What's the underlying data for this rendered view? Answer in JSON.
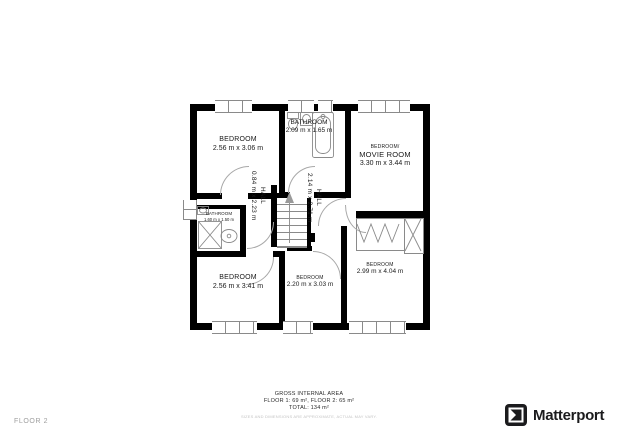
{
  "floor_label": "FLOOR 2",
  "rooms": {
    "bedroom_tl": {
      "name": "BEDROOM",
      "dims": "2.56 m x 3.06 m"
    },
    "bathroom_top": {
      "name": "BATHROOM",
      "dims": "2.09 m x 1.65 m"
    },
    "movie_room": {
      "prefix": "BEDROOM/",
      "name": "MOVIE ROOM",
      "dims": "3.30 m x 3.44 m"
    },
    "bathroom_small": {
      "name": "BATHROOM",
      "dims": "1.60 m x 1.50 m"
    },
    "hall_1": {
      "name": "HALL",
      "dims": "0.84 m x 2.23 m"
    },
    "hall_2": {
      "name": "HALL",
      "dims": "2.14 m x 2.71 m"
    },
    "bedroom_bl": {
      "name": "BEDROOM",
      "dims": "2.56 m x 3.41 m"
    },
    "bedroom_bm": {
      "name": "BEDROOM",
      "dims": "2.20 m x 3.03 m"
    },
    "bedroom_br": {
      "name": "BEDROOM",
      "dims": "2.99 m x 4.04 m"
    }
  },
  "footer": {
    "title": "GROSS INTERNAL AREA",
    "floors": "FLOOR 1: 69 m², FLOOR 2: 65 m²",
    "total": "TOTAL: 134 m²",
    "disclaimer": "SIZES AND DIMENSIONS ARE APPROXIMATE, ACTUAL MAY VARY."
  },
  "brand": {
    "name": "Matterport"
  },
  "colors": {
    "wall": "#000000",
    "fixture_line": "#8a8a8a",
    "label_text": "#1a1a1a",
    "muted_text": "#9e9e9e",
    "disclaimer_text": "#c4c4c4",
    "brand_dark": "#1b1b1d"
  }
}
